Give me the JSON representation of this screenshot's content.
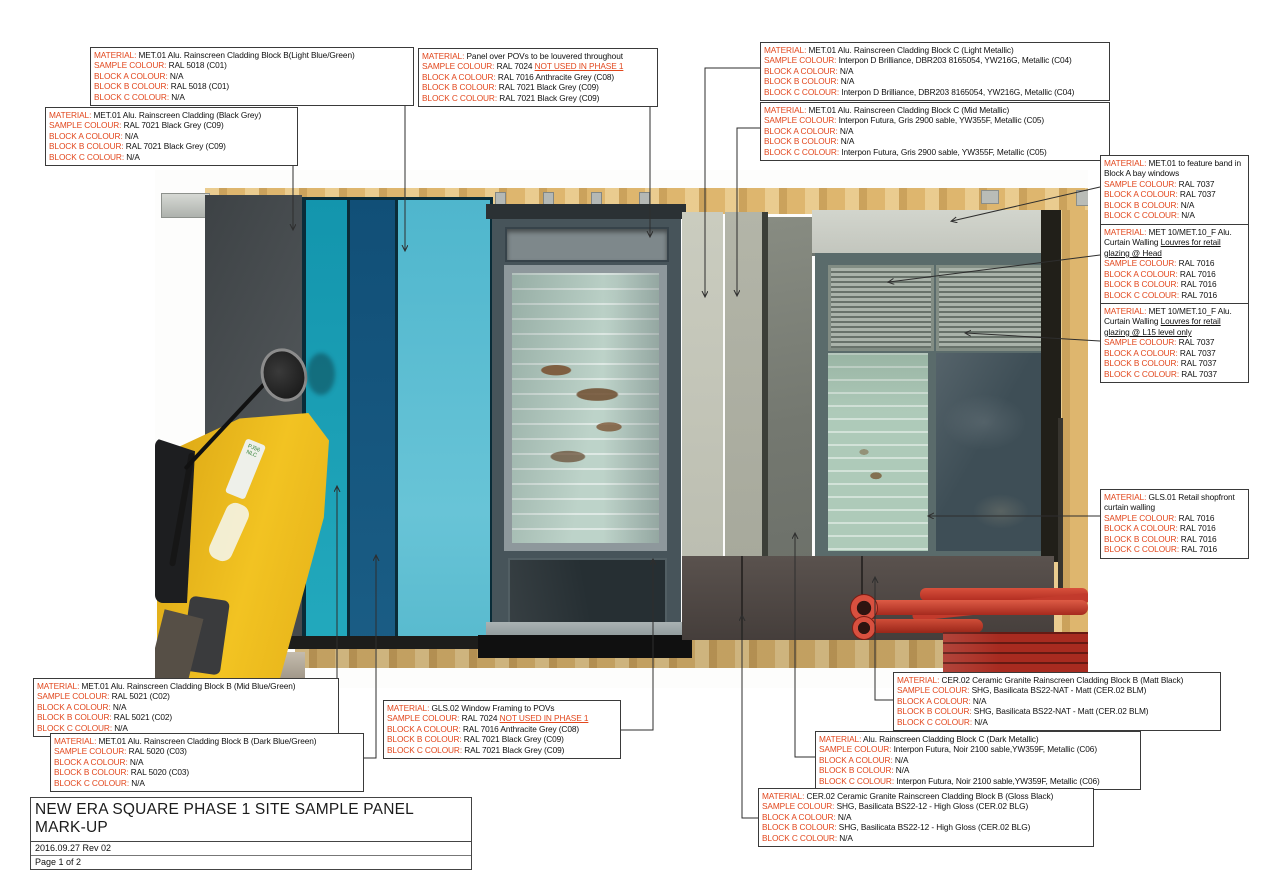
{
  "page": {
    "title": "NEW ERA SQUARE PHASE 1 SITE SAMPLE PANEL MARK-UP",
    "revision": "2016.09.27 Rev 02",
    "page_number": "Page 1 of 2"
  },
  "field_labels": {
    "material": "MATERIAL:",
    "sample": "SAMPLE COLOUR:",
    "block_a": "BLOCK A COLOUR:",
    "block_b": "BLOCK B COLOUR:",
    "block_c": "BLOCK C COLOUR:"
  },
  "alert_text": "NOT USED IN PHASE 1",
  "palette": {
    "label_red": "#e2471d",
    "leader_line": "#2e2e2e",
    "panel_light_blue_green": "#68c4d7",
    "panel_mid_blue_green": "#1ea2b7",
    "panel_dark_blue_green": "#15557d",
    "panel_black_grey": "#474c4f",
    "plywood": "#d9b269",
    "scaffold_red": "#c5372a",
    "excavator_yellow": "#f2c322"
  },
  "photo": {
    "plate_text": "PJ56 NLC"
  },
  "annotations": [
    {
      "id": "block-b-light-blue-green",
      "box": {
        "x": 90,
        "y": 47,
        "w": 316
      },
      "material": "MET.01 Alu. Rainscreen Cladding Block B(Light Blue/Green)",
      "sample": "RAL 5018 (C01)",
      "block_a": "N/A",
      "block_b": "RAL 5018 (C01)",
      "block_c": "N/A",
      "leader": [
        [
          402,
          97
        ],
        [
          405,
          97
        ],
        [
          405,
          250
        ]
      ]
    },
    {
      "id": "black-grey-cladding",
      "box": {
        "x": 45,
        "y": 107,
        "w": 245
      },
      "material": "MET.01 Alu. Rainscreen Cladding (Black Grey)",
      "sample": "RAL 7021 Black Grey (C09)",
      "block_a": "N/A",
      "block_b": "RAL 7021 Black Grey (C09)",
      "block_c": "N/A",
      "leader": [
        [
          290,
          133
        ],
        [
          293,
          133
        ],
        [
          293,
          229
        ]
      ]
    },
    {
      "id": "panel-over-povs",
      "box": {
        "x": 418,
        "y": 48,
        "w": 232
      },
      "material": "Panel over POVs to be louvered throughout",
      "sample": "RAL 7024",
      "sample_alert": true,
      "block_a": "RAL 7016 Anthracite Grey (C08)",
      "block_b": "RAL 7021 Black Grey (C09)",
      "block_c": "RAL 7021 Black Grey (C09)",
      "leader": [
        [
          650,
          75
        ],
        [
          650,
          236
        ]
      ]
    },
    {
      "id": "block-c-light-metallic",
      "box": {
        "x": 760,
        "y": 42,
        "w": 342
      },
      "material": "MET.01 Alu. Rainscreen Cladding Block C (Light Metallic)",
      "sample": "Interpon D Brilliance, DBR203 8165054, YW216G, Metallic (C04)",
      "block_a": "N/A",
      "block_b": "N/A",
      "block_c": "Interpon D Brilliance, DBR203 8165054, YW216G, Metallic (C04)",
      "leader": [
        [
          760,
          68
        ],
        [
          705,
          68
        ],
        [
          705,
          296
        ]
      ]
    },
    {
      "id": "block-c-mid-metallic",
      "box": {
        "x": 760,
        "y": 102,
        "w": 342
      },
      "material": "MET.01 Alu. Rainscreen Cladding Block C (Mid Metallic)",
      "sample": "Interpon Futura, Gris 2900 sable, YW355F, Metallic (C05)",
      "block_a": "N/A",
      "block_b": "N/A",
      "block_c": "Interpon Futura, Gris 2900 sable, YW355F, Metallic (C05)",
      "leader": [
        [
          760,
          128
        ],
        [
          737,
          128
        ],
        [
          737,
          295
        ]
      ]
    },
    {
      "id": "feature-band-bay-windows",
      "box": {
        "x": 1100,
        "y": 155,
        "w": 141
      },
      "material": "MET.01 to feature band in Block A bay windows",
      "sample": "RAL 7037",
      "block_a": "RAL 7037",
      "block_b": "N/A",
      "block_c": "N/A",
      "leader": [
        [
          1100,
          187
        ],
        [
          952,
          221
        ]
      ]
    },
    {
      "id": "louvres-retail-head",
      "box": {
        "x": 1100,
        "y": 224,
        "w": 141
      },
      "material": "MET 10/MET.10_F Alu. Curtain Walling ",
      "material_underline": "Louvres for retail glazing @ Head",
      "sample": "RAL 7016",
      "block_a": "RAL 7016",
      "block_b": "RAL 7016",
      "block_c": "RAL 7016",
      "leader": [
        [
          1100,
          255
        ],
        [
          889,
          282
        ]
      ]
    },
    {
      "id": "louvres-retail-l15",
      "box": {
        "x": 1100,
        "y": 303,
        "w": 141
      },
      "material": "MET 10/MET.10_F Alu. Curtain Walling ",
      "material_underline": "Louvres for retail glazing @ L15 level only",
      "sample": "RAL 7037",
      "block_a": "RAL 7037",
      "block_b": "RAL 7037",
      "block_c": "RAL 7037",
      "leader": [
        [
          1100,
          341
        ],
        [
          966,
          333
        ]
      ]
    },
    {
      "id": "retail-shopfront-curtain-walling",
      "box": {
        "x": 1100,
        "y": 489,
        "w": 141
      },
      "material": "GLS.01 Retail shopfront curtain walling",
      "sample": "RAL 7016",
      "block_a": "RAL 7016",
      "block_b": "RAL 7016",
      "block_c": "RAL 7016",
      "leader": [
        [
          1100,
          516
        ],
        [
          929,
          516
        ]
      ]
    },
    {
      "id": "block-b-mid-blue-green",
      "box": {
        "x": 33,
        "y": 678,
        "w": 298
      },
      "material": "MET.01 Alu. Rainscreen Cladding Block B (Mid Blue/Green)",
      "sample": "RAL 5021 (C02)",
      "block_a": "N/A",
      "block_b": "RAL 5021 (C02)",
      "block_c": "N/A",
      "leader": [
        [
          331,
          703
        ],
        [
          337,
          703
        ],
        [
          337,
          487
        ]
      ]
    },
    {
      "id": "block-b-dark-blue-green",
      "box": {
        "x": 50,
        "y": 733,
        "w": 306
      },
      "material": "MET.01 Alu. Rainscreen Cladding Block B (Dark Blue/Green)",
      "sample": "RAL 5020 (C03)",
      "block_a": "N/A",
      "block_b": "RAL 5020 (C03)",
      "block_c": "N/A",
      "leader": [
        [
          356,
          758
        ],
        [
          376,
          758
        ],
        [
          376,
          556
        ]
      ]
    },
    {
      "id": "window-framing-povs",
      "box": {
        "x": 383,
        "y": 700,
        "w": 230
      },
      "material": "GLS.02 Window Framing to POVs",
      "sample": "RAL 7024",
      "sample_alert": true,
      "block_a": "RAL 7016 Anthracite Grey (C08)",
      "block_b": "RAL 7021 Black Grey (C09)",
      "block_c": "RAL 7021 Black Grey (C09)",
      "leader": [
        [
          613,
          730
        ],
        [
          653,
          730
        ],
        [
          653,
          560
        ]
      ]
    },
    {
      "id": "ceramic-granite-matt-black",
      "box": {
        "x": 893,
        "y": 672,
        "w": 320
      },
      "material": "CER.02 Ceramic Granite Rainscreen Cladding Block B (Matt Black)",
      "sample": "SHG, Basilicata BS22-NAT - Matt (CER.02 BLM)",
      "block_a": "N/A",
      "block_b": "SHG, Basilicata BS22-NAT - Matt (CER.02 BLM)",
      "block_c": "N/A",
      "leader": [
        [
          893,
          700
        ],
        [
          875,
          700
        ],
        [
          875,
          578
        ]
      ]
    },
    {
      "id": "block-c-dark-metallic",
      "box": {
        "x": 815,
        "y": 731,
        "w": 318
      },
      "material": "Alu. Rainscreen Cladding Block C (Dark Metallic)",
      "sample": "Interpon Futura, Noir 2100 sable,YW359F, Metallic (C06)",
      "block_a": "N/A",
      "block_b": "N/A",
      "block_c": "Interpon Futura, Noir 2100 sable,YW359F, Metallic (C06)",
      "leader": [
        [
          815,
          757
        ],
        [
          795,
          757
        ],
        [
          795,
          534
        ]
      ]
    },
    {
      "id": "ceramic-granite-gloss-black",
      "box": {
        "x": 758,
        "y": 788,
        "w": 328
      },
      "material": "CER.02 Ceramic Granite Rainscreen Cladding Block B (Gloss Black)",
      "sample": "SHG, Basilicata BS22-12 - High Gloss (CER.02 BLG)",
      "block_a": "N/A",
      "block_b": "SHG, Basilicata BS22-12 - High Gloss (CER.02 BLG)",
      "block_c": "N/A",
      "leader": [
        [
          758,
          818
        ],
        [
          742,
          818
        ],
        [
          742,
          616
        ]
      ]
    }
  ]
}
